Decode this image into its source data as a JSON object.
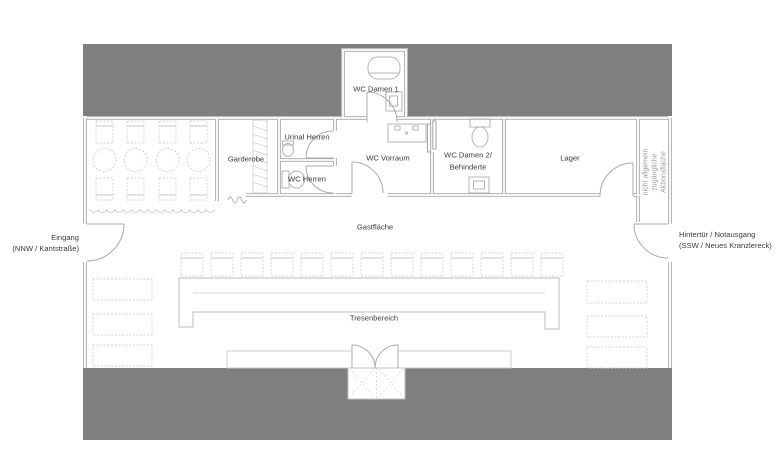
{
  "rooms": {
    "wc_damen_1": "WC Damen 1",
    "urinal_herren": "Urinal Herren",
    "garderobe": "Garderobe",
    "wc_herren": "WC Herren",
    "wc_vorraum": "WC Vorraum",
    "wc_damen_2_line1": "WC Damen 2/",
    "wc_damen_2_line2": "Behinderte",
    "lager": "Lager",
    "gastflaeche": "Gastfläche",
    "tresenbereich": "Tresenbereich"
  },
  "annotations": {
    "entrance_line1": "Eingang",
    "entrance_line2": "(NNW / Kantstraße)",
    "backdoor_line1": "Hintertür / Notausgang",
    "backdoor_line2": "(SSW / Neues Kranzlereck)",
    "restricted_line1": "nicht allgemein",
    "restricted_line2": "zugängliche",
    "restricted_line3": "Aktionsfläche"
  },
  "colors": {
    "solid_band": "#7f7f7f",
    "wall": "#a6a6a6",
    "fixture": "#b5b5b5",
    "furniture": "#d2d2d2",
    "label_text": "#3a3a3a",
    "muted_text": "#9b9b9b"
  }
}
